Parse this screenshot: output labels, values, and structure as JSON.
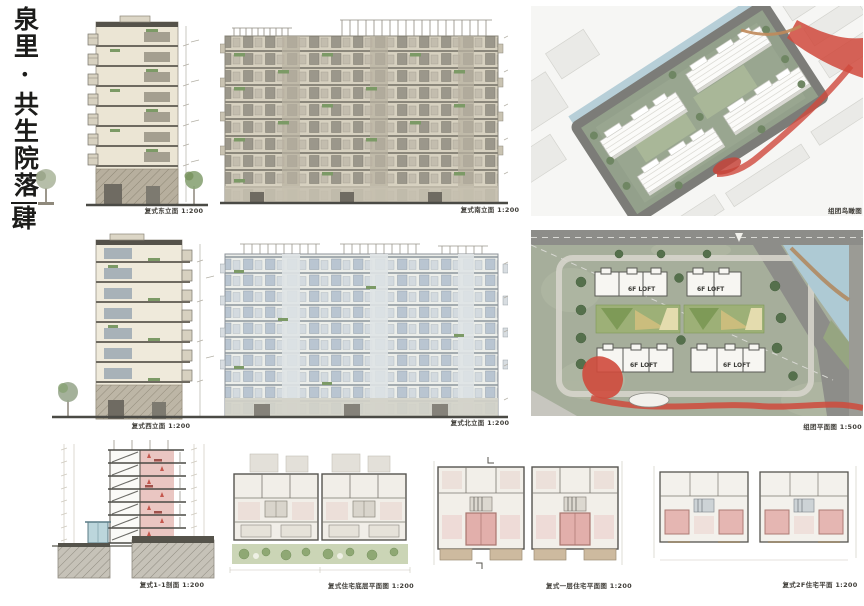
{
  "board": {
    "title_vertical": "泉里·共生院落",
    "title_number": "肆"
  },
  "panels": {
    "east_elevation": {
      "caption": "复式东立面 1:200"
    },
    "south_elevation": {
      "caption": "复式南立面 1:200"
    },
    "birdseye": {
      "caption": "组团鸟瞰图"
    },
    "west_elevation": {
      "caption": "复式西立面 1:200"
    },
    "north_elevation": {
      "caption": "复式北立面 1:200"
    },
    "site_plan": {
      "caption": "组团平面图 1:500",
      "building_labels": [
        "6F LOFT",
        "6F LOFT",
        "6F LOFT",
        "6F LOFT"
      ]
    },
    "section": {
      "caption": "复式1-1剖面 1:200"
    },
    "ground_floor_plan": {
      "caption": "复式住宅底层平面图 1:200"
    },
    "first_floor_plan": {
      "caption": "复式一层住宅平面图 1:200"
    },
    "second_floor_plan": {
      "caption": "复式2F住宅平面 1:200"
    }
  },
  "colors": {
    "accent_red": "#cf4a3c",
    "site_green": "#a6ae9b",
    "water_blue": "#aecad4",
    "plan_pink": "#e5b6b2",
    "wall_cream": "#ebe5d4",
    "glass_blue": "#b9c5d1",
    "planter_green": "#7c9a66",
    "road_gray": "#8d8d89",
    "ink": "#3f3d38"
  }
}
